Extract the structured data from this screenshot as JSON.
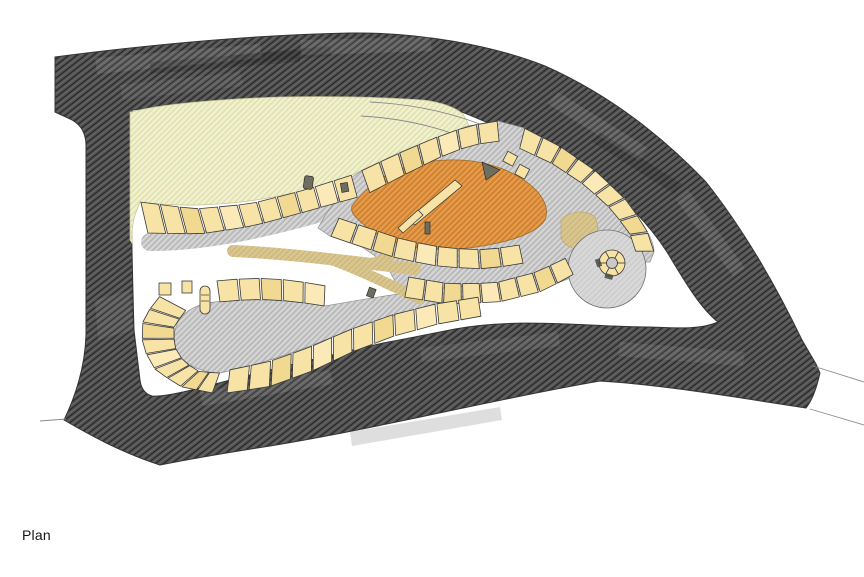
{
  "caption": {
    "label": "Plan"
  },
  "palette": {
    "background": "#ffffff",
    "road_band": "#535353",
    "road_hatch": "#262626",
    "meadow": "#ededc6",
    "path_gray": "#c9c9c9",
    "plaza_orange": "#dd8e3d",
    "path_tan": "#d9c68f",
    "unit_fill": "#f7e3a6",
    "unit_fill_alt": "#f1d992",
    "unit_fill_alt2": "#fbeab8",
    "unit_outline": "#3a3a3a",
    "circle_plaza": "#d8d8d8",
    "line_thin": "#8a8a8a"
  }
}
